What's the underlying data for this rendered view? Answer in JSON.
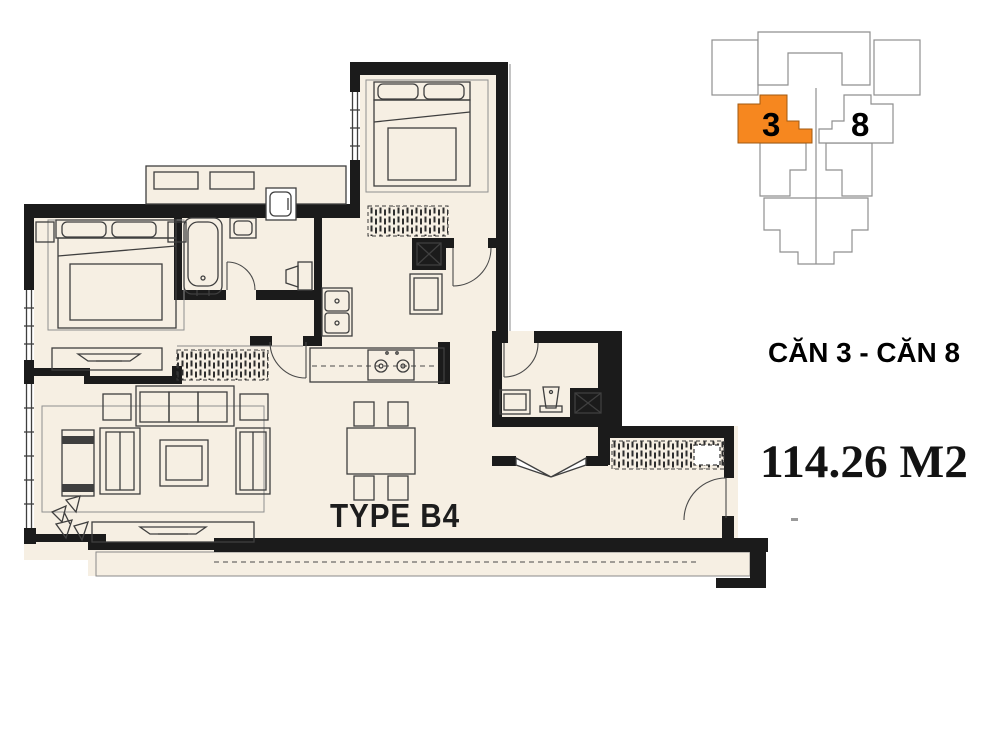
{
  "plan": {
    "type_label": "TYPE B4"
  },
  "key_plan": {
    "highlighted_unit": "3",
    "adjacent_unit": "8"
  },
  "captions": {
    "unit_caption": "CĂN 3 - CĂN 8",
    "area_caption": "114.26 M2"
  },
  "colors": {
    "background": "#ffffff",
    "floor_fill": "#f6efe3",
    "wall": "#1b1b1b",
    "furniture_line": "#3f3f3f",
    "keyplan_outline": "#8f8f8f",
    "highlight_orange": "#f6871f",
    "text": "#111111"
  }
}
